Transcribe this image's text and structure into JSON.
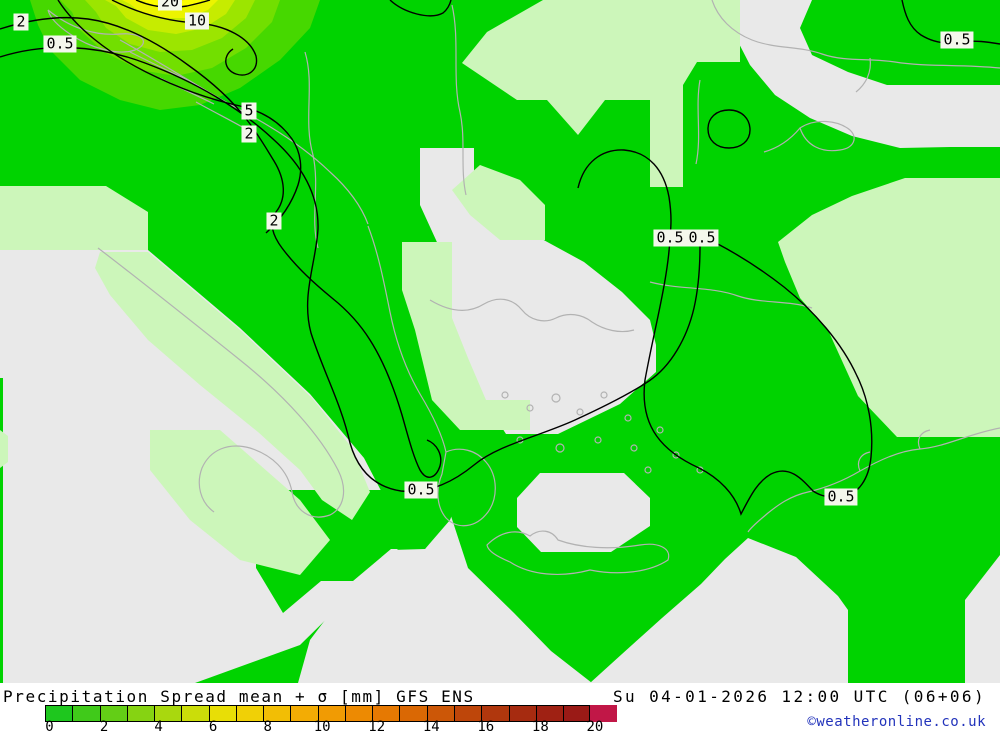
{
  "caption": {
    "title": "Precipitation Spread mean + σ [mm] GFS ENS",
    "datetime": "Su 04-01-2026 12:00 UTC (06+06)",
    "copyright": "©weatheronline.co.uk"
  },
  "map": {
    "contour_labels": [
      {
        "text": "2",
        "x": 21,
        "y": 22
      },
      {
        "text": "0.5",
        "x": 60,
        "y": 44
      },
      {
        "text": "20",
        "x": 170,
        "y": 2
      },
      {
        "text": "10",
        "x": 197,
        "y": 21
      },
      {
        "text": "5",
        "x": 249,
        "y": 111
      },
      {
        "text": "2",
        "x": 249,
        "y": 134
      },
      {
        "text": "2",
        "x": 274,
        "y": 221
      },
      {
        "text": "0.5",
        "x": 670,
        "y": 238
      },
      {
        "text": "0.5",
        "x": 702,
        "y": 238
      },
      {
        "text": "0.5",
        "x": 421,
        "y": 490
      },
      {
        "text": "0.5",
        "x": 841,
        "y": 497
      },
      {
        "text": "0.5",
        "x": 957,
        "y": 40
      }
    ],
    "colors": {
      "sea_gray": "#e9e9e9",
      "precip_green": "#00d300",
      "precip_pale": "#ccf6ba",
      "coastline": "#b2b2b2",
      "contour": "#000000"
    }
  },
  "legend": {
    "unit": "mm",
    "ticks": [
      "0",
      "2",
      "4",
      "6",
      "8",
      "10",
      "12",
      "14",
      "16",
      "18",
      "20"
    ],
    "tick_values": [
      0,
      2,
      4,
      6,
      8,
      10,
      12,
      14,
      16,
      18,
      20
    ],
    "cell_colors": [
      "#1ec71e",
      "#40ca1a",
      "#63ce16",
      "#86d312",
      "#a9d80e",
      "#cbdd09",
      "#e8de06",
      "#f0d006",
      "#f2be05",
      "#f3ac04",
      "#f19b03",
      "#ed8a02",
      "#e67902",
      "#da6804",
      "#cc5707",
      "#be460a",
      "#b0370d",
      "#a62b10",
      "#9f2113",
      "#9a1a16"
    ],
    "overflow_color": "#c11747"
  }
}
